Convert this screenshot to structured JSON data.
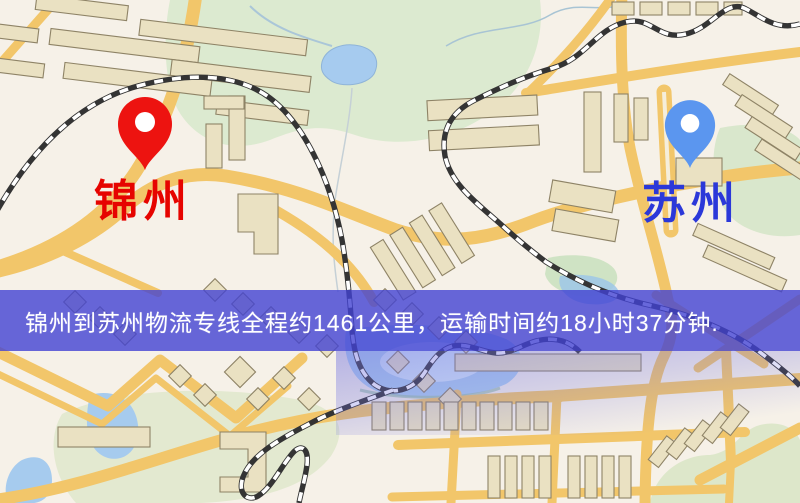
{
  "banner": {
    "text": "锦州到苏州物流专线全程约1461公里，运输时间约18小时37分钟.",
    "background": "#4242d2",
    "text_color": "#ffffff"
  },
  "markers": {
    "origin": {
      "label": "锦州",
      "pin_color": "#ed1310",
      "label_color": "#e60400"
    },
    "destination": {
      "label": "苏州",
      "pin_color": "#5b96ef",
      "label_color": "#2b38d9"
    }
  },
  "map_palette": {
    "background": "#f6f1e8",
    "road": "#f2c66a",
    "park": "#dcead0",
    "water": "#a9cdf0",
    "building": "#eae1c2",
    "railway": "#343434"
  }
}
